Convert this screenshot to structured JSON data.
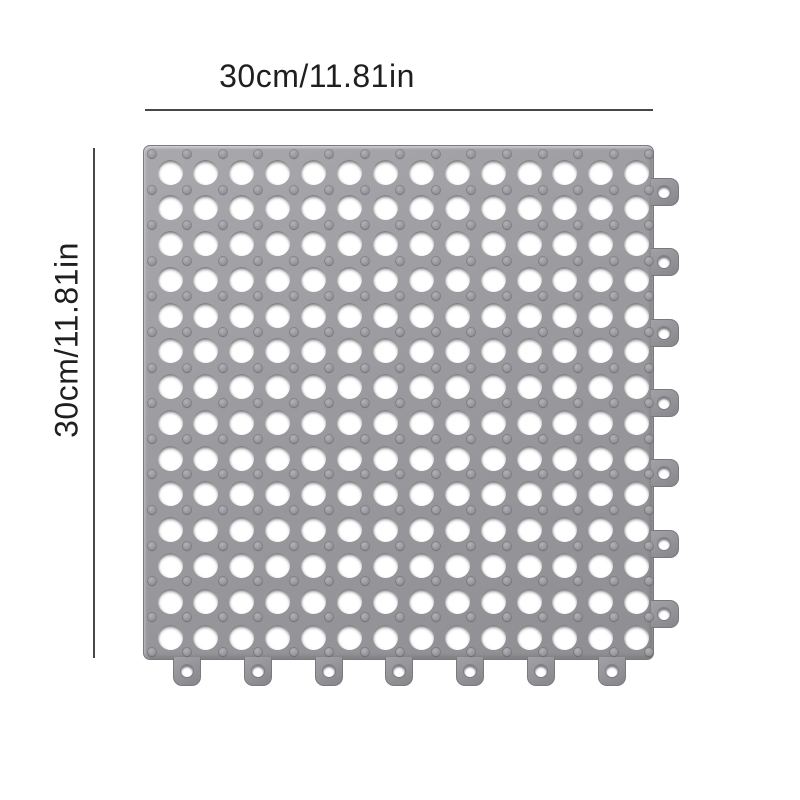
{
  "diagram": {
    "title": "interlocking drain mat tile dimension diagram",
    "background": "#ffffff",
    "annotation_color": "#1f1f21",
    "line_color": "#47474b"
  },
  "dimensions": {
    "top_label": "30cm/11.81in",
    "left_label": "30cm/11.81in",
    "width_cm": 30,
    "width_in": 11.81,
    "height_cm": 30,
    "height_in": 11.81
  },
  "mat": {
    "name": "gray interlocking drainage mat tile",
    "color_body": "#9b9b9f",
    "color_body_light": "#a9a9ad",
    "color_body_dark": "#8f8f93",
    "color_edge": "#7a7a7e",
    "hole_color": "#ffffff",
    "grid": {
      "hole_rows": 14,
      "hole_cols": 14,
      "bump_rows": 15,
      "bump_cols": 15
    },
    "loops": {
      "right_count": 7,
      "bottom_count": 7
    }
  }
}
